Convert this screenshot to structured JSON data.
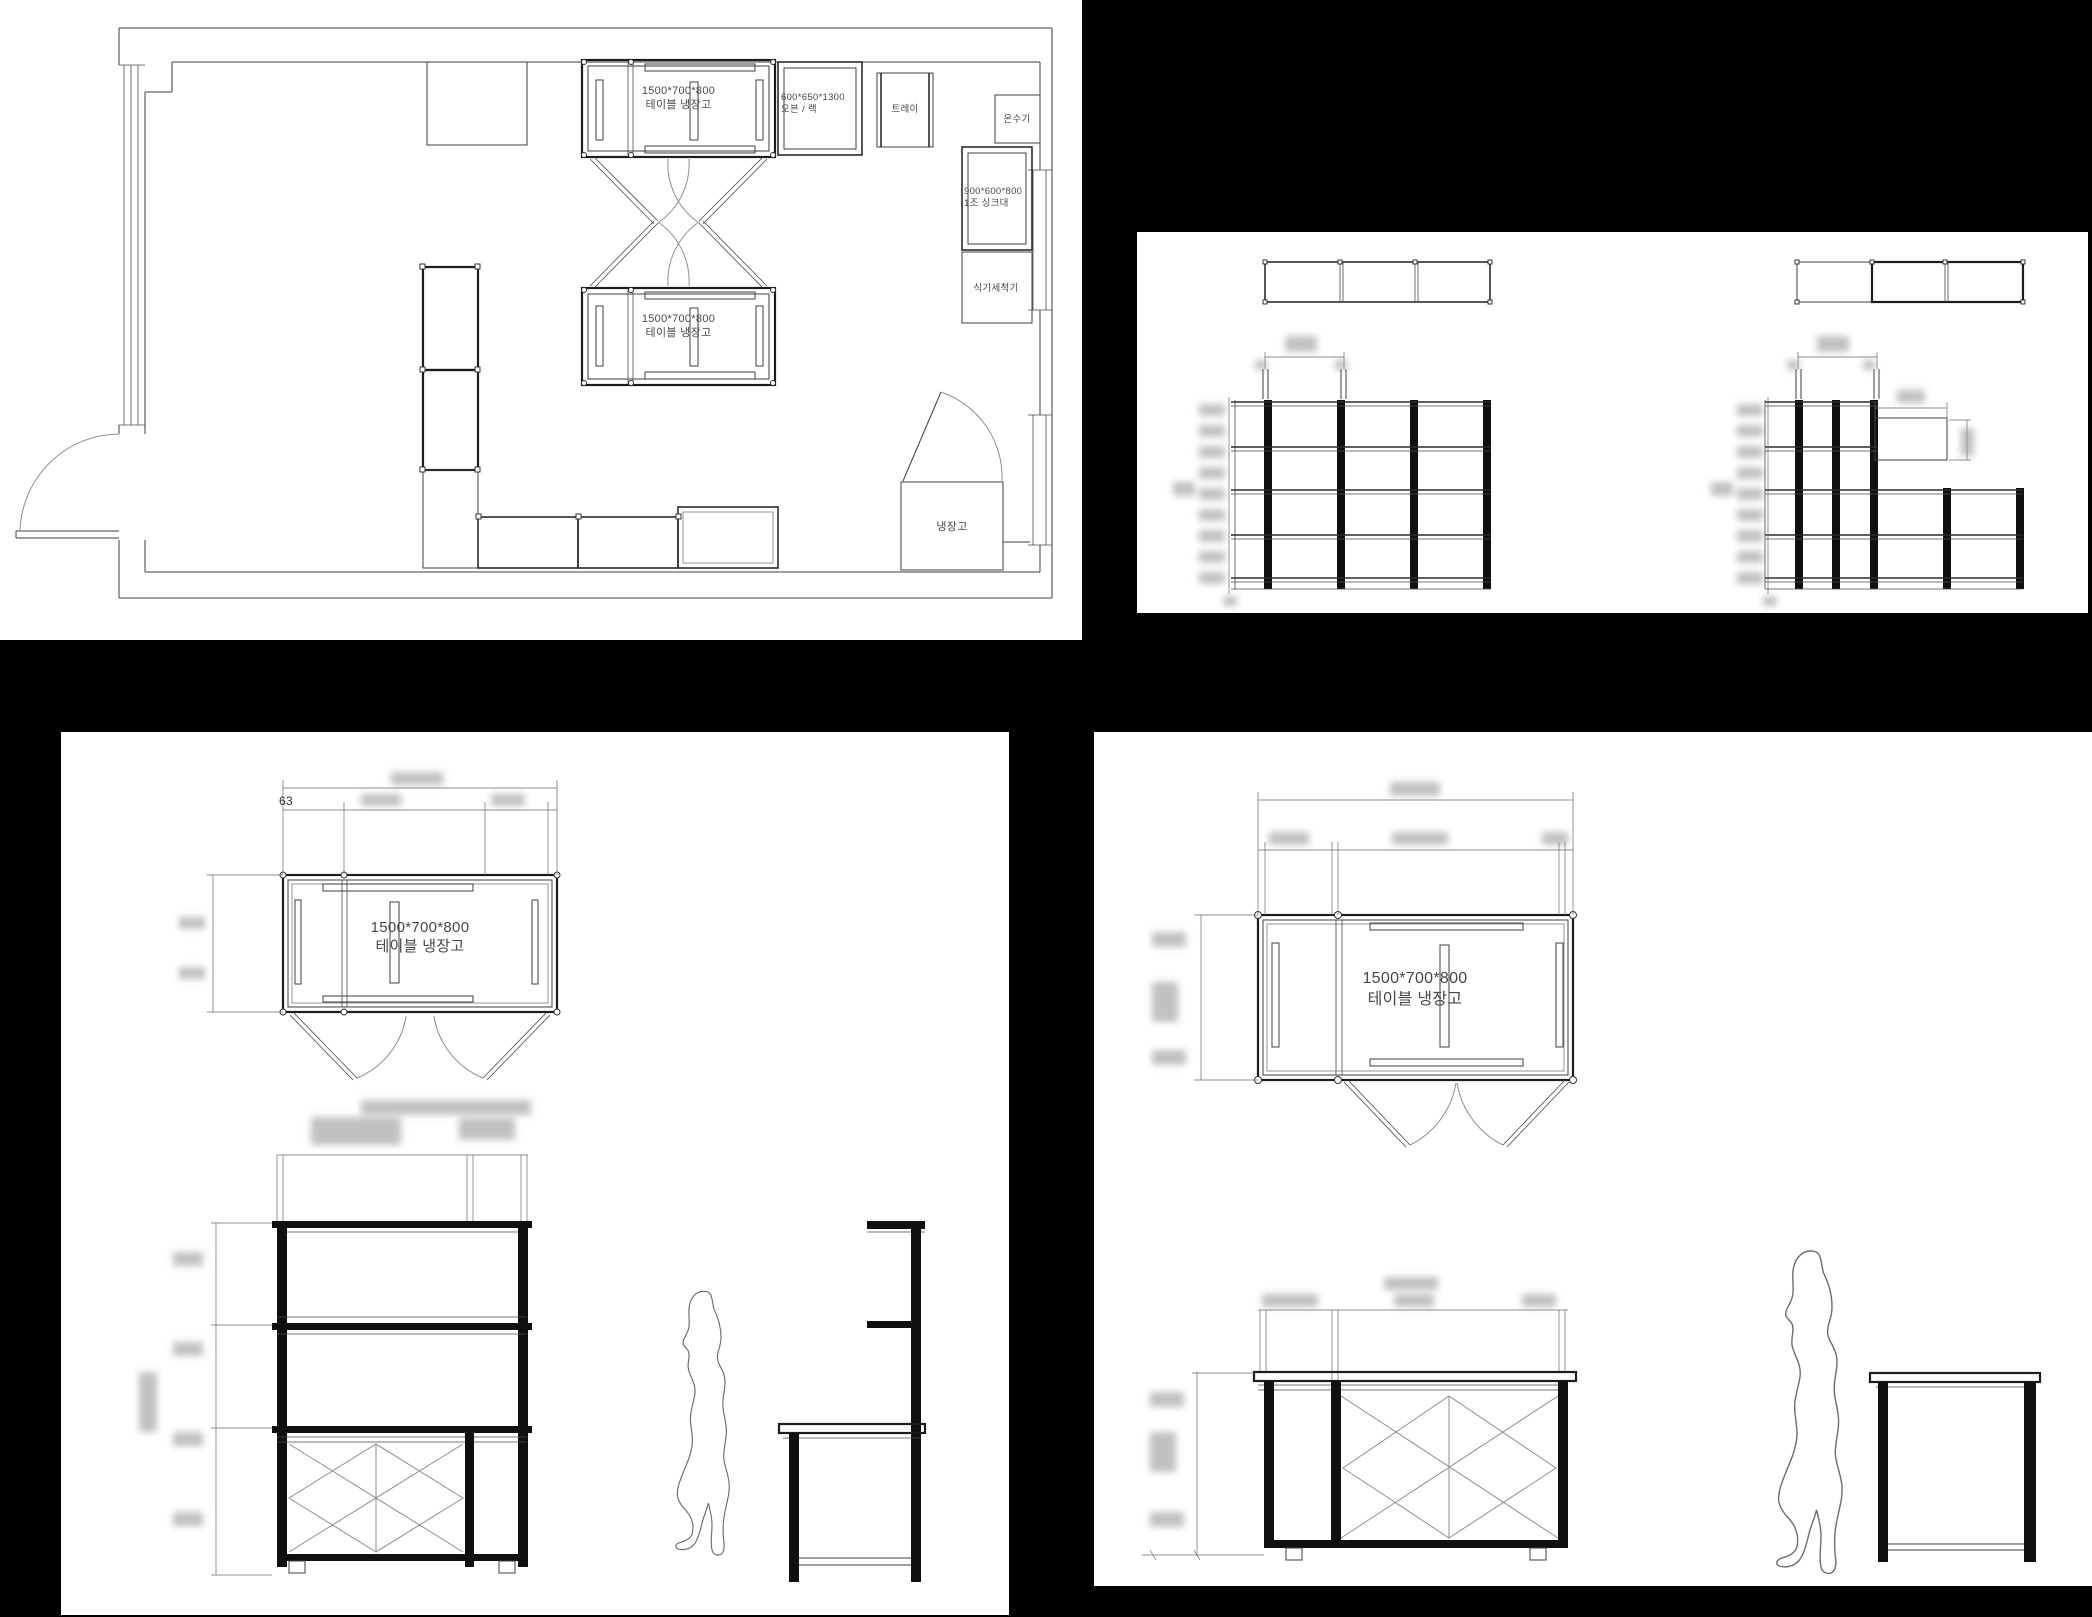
{
  "colors": {
    "background": "#000000",
    "panel": "#ffffff",
    "linework": "#3f3f3f",
    "ink": "#111111",
    "label_text": "#4a4a4a"
  },
  "floor_plan": {
    "labels": {
      "table_fridge_top": [
        "1500*700*800",
        "테이블 냉장고"
      ],
      "table_fridge_middle": [
        "1500*700*800",
        "테이블 냉장고"
      ],
      "oven_rack": [
        "600*650*1300",
        "오븐 / 랙"
      ],
      "tray": "트레이",
      "water_heater": "온수기",
      "sink": [
        "900*600*800",
        "1조 싱크대"
      ],
      "dishwasher": "식기세척기",
      "refrigerator": "냉장고"
    }
  },
  "detail_sheet_left": {
    "dim_offset": "63",
    "table_label": [
      "1500*700*800",
      "테이블 냉장고"
    ]
  },
  "detail_sheet_right": {
    "table_label": [
      "1500*700*800",
      "테이블 냉장고"
    ]
  }
}
